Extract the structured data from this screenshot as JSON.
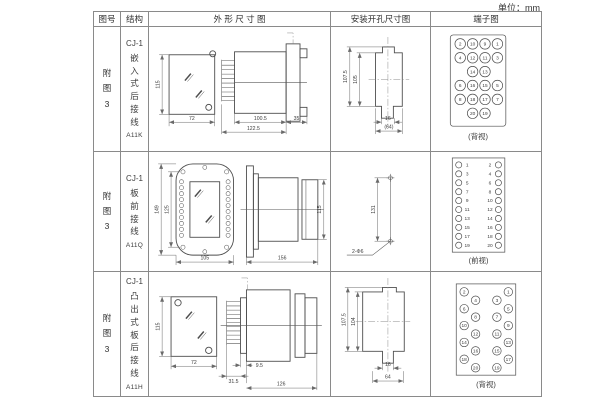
{
  "unit_label": "单位：mm",
  "headers": [
    "图号",
    "结构",
    "外 形 尺 寸 图",
    "安装开孔尺寸图",
    "端子图"
  ],
  "rows": [
    {
      "figure_no": "附图3",
      "structure": {
        "model": "CJ-1",
        "name": "嵌入式后接线",
        "code": "A11K"
      },
      "outline": {
        "height": "115",
        "width": "72",
        "body_depth": "100.5",
        "total_depth": "122.5",
        "flange_depth": "35"
      },
      "install": {
        "outer_height": "107.5",
        "opening_height": "105",
        "slot_width": "16",
        "total_width": "(64)"
      },
      "terminal": {
        "view": "(背视)",
        "grid": [
          [
            "2",
            "10",
            "9",
            "1"
          ],
          [
            "4",
            "12",
            "11",
            "3"
          ],
          [
            "14",
            "13"
          ],
          [
            "6",
            "16",
            "15",
            "5"
          ],
          [
            "8",
            "18",
            "17",
            "7"
          ],
          [
            "20",
            "19"
          ]
        ]
      }
    },
    {
      "figure_no": "附图3",
      "structure": {
        "model": "CJ-1",
        "name": "板前接线",
        "code": "A11Q"
      },
      "outline": {
        "outer_height": "149",
        "hole_pitch": "125",
        "width": "105",
        "depth": "156",
        "body_height": "115"
      },
      "install": {
        "hole_pitch": "131",
        "holes_label": "2-Φ6"
      },
      "terminal": {
        "view": "(前视)",
        "left": [
          "1",
          "3",
          "5",
          "7",
          "9",
          "11",
          "13",
          "15",
          "17",
          "19"
        ],
        "right": [
          "2",
          "4",
          "6",
          "8",
          "10",
          "12",
          "14",
          "16",
          "18",
          "20"
        ]
      }
    },
    {
      "figure_no": "附图3",
      "structure": {
        "model": "CJ-1",
        "name": "凸出式板后接线",
        "code": "A11H"
      },
      "outline": {
        "height": "115",
        "width": "72",
        "flange_depth": "9.5",
        "pins_depth": "31.5",
        "depth": "126"
      },
      "install": {
        "outer_height": "107.5",
        "opening_height": "104",
        "slot_width": "16",
        "total_width": "64"
      },
      "terminal": {
        "view": "(背视)",
        "left_outer": [
          "2",
          "6",
          "10",
          "14",
          "18"
        ],
        "left_inner": [
          "4",
          "8",
          "12",
          "16",
          "20"
        ],
        "right_inner": [
          "3",
          "7",
          "11",
          "15",
          "19"
        ],
        "right_outer": [
          "1",
          "5",
          "9",
          "13",
          "17"
        ]
      }
    }
  ]
}
